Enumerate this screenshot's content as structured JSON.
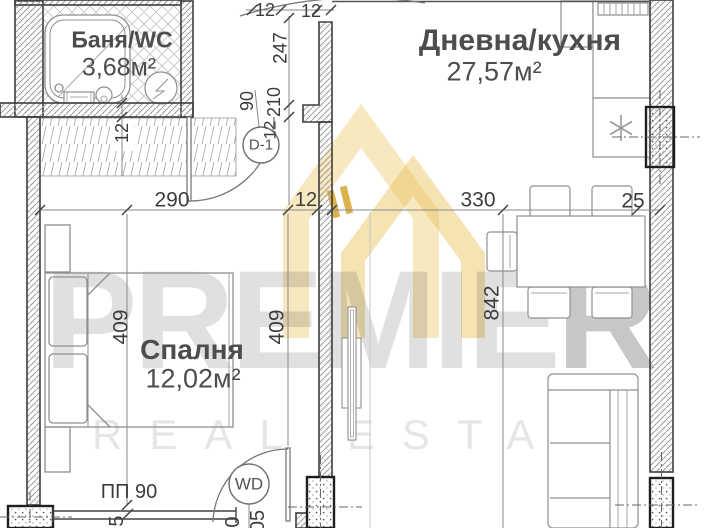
{
  "watermark": {
    "brand_main": "PREMIE",
    "brand_last": "R",
    "tagline": "REAL ESTATE"
  },
  "rooms": {
    "bathroom": {
      "name": "Баня/WC",
      "area": "3,68м²"
    },
    "living": {
      "name": "Дневна/кухня",
      "area": "27,57м²"
    },
    "bedroom": {
      "name": "Спалня",
      "area": "12,02м²"
    }
  },
  "tags": {
    "door_tag": "D-1",
    "window_door_tag": "WD",
    "parapet_label": "ПП 90"
  },
  "dims": {
    "bedroom_width": "290",
    "partition_thickness": "12",
    "living_width": "330",
    "right_wall_thickness": "25",
    "hall_depth": "247",
    "top_wall_a": "12",
    "top_wall_b": "12",
    "door_width": "90",
    "door_height": "210",
    "door_wall": "12",
    "bedroom_depth_left": "409",
    "bedroom_depth_right": "409",
    "living_depth": "842",
    "closet_wall": "12",
    "edge_fragment_left": "5",
    "edge_fragment_mid": "0",
    "edge_fragment_right": "05"
  },
  "colors": {
    "accent_gold": "#D9A432",
    "watermark_gray": "#DEDEDE",
    "wall_line": "#3E3E3E",
    "dim_text": "#3C3C3C"
  }
}
